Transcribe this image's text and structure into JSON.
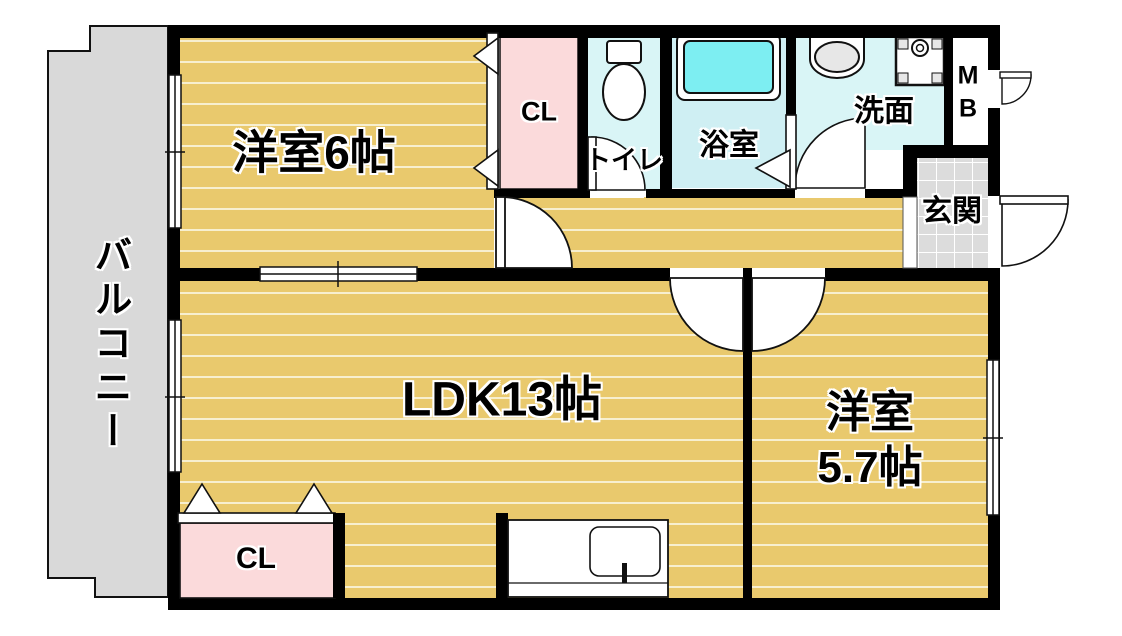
{
  "figure": "apartment-floor-plan",
  "rooms": {
    "west6": {
      "label": "洋室6帖"
    },
    "ldk": {
      "label": "LDK13帖"
    },
    "west57_line1": "洋室",
    "west57_line2": "5.7帖",
    "closet_top": {
      "label": "CL"
    },
    "closet_bottom": {
      "label": "CL"
    },
    "toilet": {
      "label": "トイレ"
    },
    "bath": {
      "label": "浴室"
    },
    "washroom": {
      "label": "洗面"
    },
    "entrance": {
      "label": "玄関"
    },
    "meter_box_line1": "M",
    "meter_box_line2": "B",
    "balcony": {
      "label": "バルコニー"
    }
  },
  "colors": {
    "wall": "#000000",
    "line": "#111111",
    "wood": "#e9c96d",
    "wood_stripe": "#f7efcf",
    "balcony": "#d9d9d9",
    "closet_pink": "#fbdadb",
    "water_floor": "#d9f5f6",
    "bath_floor": "#cfeff3",
    "tub": "#7deef2",
    "tile": "#dcdcdc",
    "tile_line": "#ffffff",
    "fixture_gray": "#e7e7e7",
    "white": "#ffffff"
  }
}
